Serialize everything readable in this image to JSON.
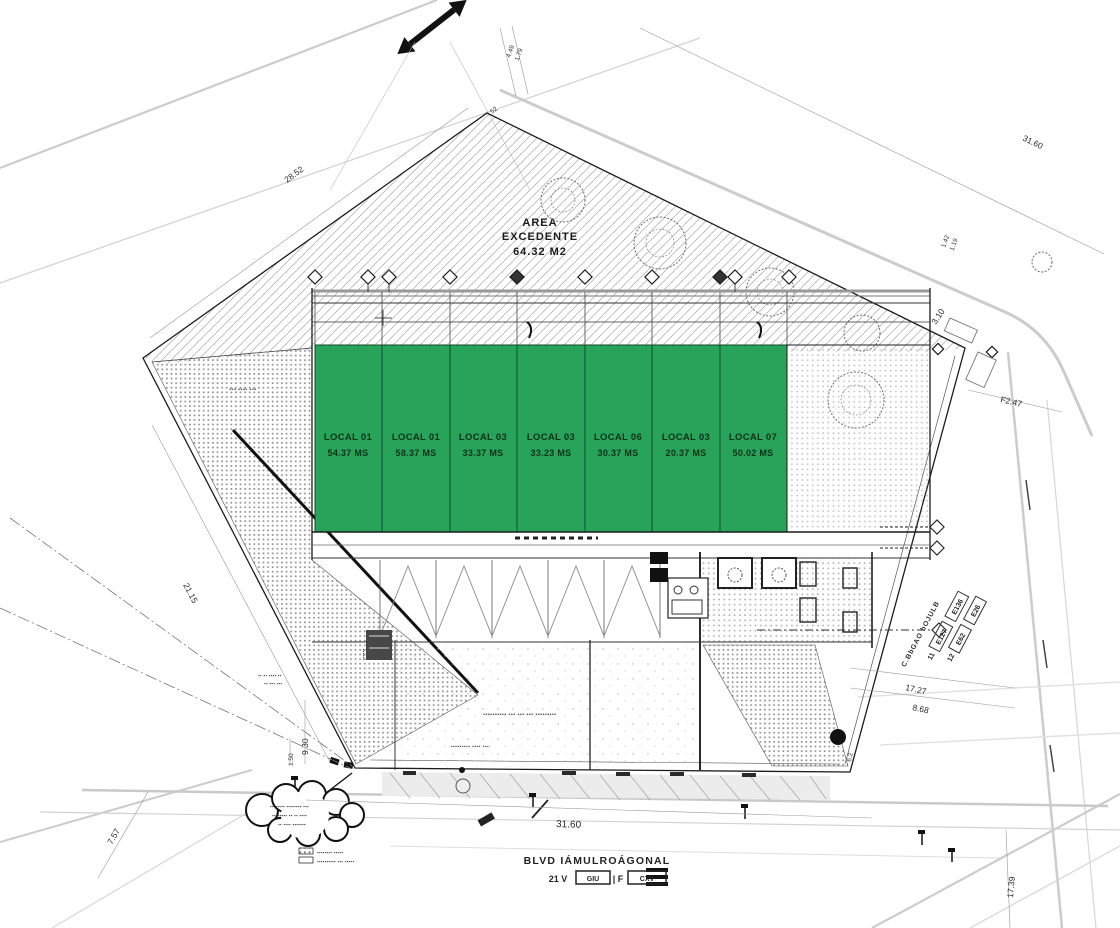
{
  "area_excedente": {
    "l1": "AREA",
    "l2": "EXCEDENTE",
    "l3": "64.32 M2"
  },
  "locals": [
    {
      "name": "LOCAL 01",
      "area": "54.37 MS"
    },
    {
      "name": "LOCAL 01",
      "area": "58.37 MS"
    },
    {
      "name": "LOCAL 03",
      "area": "33.37 MS"
    },
    {
      "name": "LOCAL 03",
      "area": "33.23 MS"
    },
    {
      "name": "LOCAL 06",
      "area": "30.37 MS"
    },
    {
      "name": "LOCAL 03",
      "area": "20.37 MS"
    },
    {
      "name": "LOCAL 07",
      "area": "50.02 MS"
    }
  ],
  "dims": {
    "top_left": "28.52",
    "top_right": "31.60",
    "top_a": "4.49",
    "top_b": "1.79",
    "top_vertex": "52",
    "right_a": "1.42",
    "right_b": "1.19",
    "right_upper": "3.10",
    "right_lot": "F2.47",
    "left_edge": "21.15",
    "corner_a": "9.30",
    "corner_b": "1.50",
    "left_bottom": "7.57",
    "right_lower_a": "17.27",
    "right_lower_b": "8.68",
    "bottom_street": "31.60",
    "bottom_right": "17.39",
    "manhole": "6.2"
  },
  "bottom_street": {
    "name": "BLVD IÁMULROÁGONAL",
    "addr_prefix": "21 V",
    "addr_box1": "GIU",
    "addr_mid": "| F",
    "addr_box2": "CXV"
  },
  "side_street": {
    "name": "C.BbGAO bOJULB",
    "r1_num": "11",
    "r1_box1": "E127",
    "r1_box2": "E136",
    "r2_num": "12",
    "r2_box1": "E62",
    "r2_box2": "E26"
  },
  "legend": {
    "row1": "▪▪▪▪▪▪▪▪ ▪▪▪▪▪",
    "row2": "▪▪▪▪▪▪▪▪▪▪ ▪▪▪ ▪▪▪▪▪"
  },
  "cloud_note": {
    "l1": "▪▪ ▪▪▪▪▪ ▪▪▪▪▪▪▪▪ ▪▪▪",
    "l2": "▪▪▪▪▪▪▪▪ ▪▪ ▪▪ ▪▪▪▪",
    "l3": "▪▪ ▪▪▪▪ ▪▪▪▪▪▪▪"
  },
  "notes": {
    "courtyard1": "▪▪▪▪▪▪▪▪▪▪ ▪▪▪ ▪▪▪ ▪▪▪ ▪▪▪▪▪▪▪▪▪",
    "courtyard2": "▪▪▪▪▪▪▪▪▪ ▪▪▪▪ ▪▪▪",
    "left_area": "▪▪▪ ▪▪▪▪ ▪▪▪",
    "corner1": "▪▪ ▪▪ ▪▪▪▪ ▪▪",
    "corner2": "▪▪ ▪▪▪ ▪▪▪",
    "ramp": "▪▪▪▪▪▪"
  },
  "colors": {
    "local_green": "#27a45a",
    "line_black": "#1c1c1c",
    "road_grey": "#cccccc"
  }
}
